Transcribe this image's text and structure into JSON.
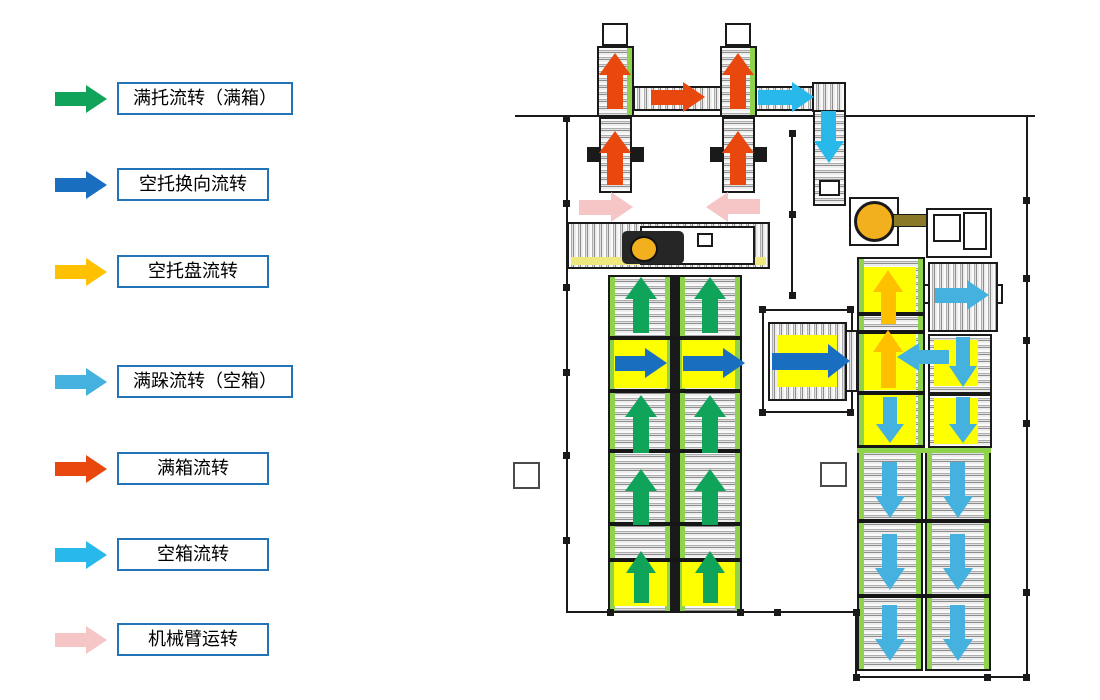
{
  "legend": {
    "items": [
      {
        "name": "full-pallet-flow",
        "label": "满托流转（满箱）",
        "flow": "full_pallet"
      },
      {
        "name": "empty-pallet-reverse-flow",
        "label": "空托换向流转",
        "flow": "empty_pallet_reverse"
      },
      {
        "name": "empty-tray-flow",
        "label": "空托盘流转",
        "flow": "empty_tray"
      },
      {
        "name": "full-stack-flow",
        "label": "满跺流转（空箱）",
        "flow": "full_stack"
      },
      {
        "name": "full-box-flow",
        "label": "满箱流转",
        "flow": "full_box"
      },
      {
        "name": "empty-box-flow",
        "label": "空箱流转",
        "flow": "empty_box"
      },
      {
        "name": "robot-arm-flow",
        "label": "机械臂运转",
        "flow": "robot_arm"
      }
    ],
    "tops": [
      82,
      168,
      255,
      365,
      452,
      538,
      623
    ],
    "box_border_color": "#2273b8"
  },
  "flow_colors": {
    "full_pallet": "#10a45b",
    "empty_pallet_reverse": "#1a6ebf",
    "empty_tray": "#ffc000",
    "full_stack": "#45b1de",
    "full_box": "#e8480e",
    "empty_box": "#29b8ea",
    "robot_arm": "#f6c6c6"
  },
  "diagram": {
    "arrows": [
      {
        "t": "full_box",
        "x": 615,
        "y": 81,
        "dir": "up",
        "len": 56,
        "w": 32
      },
      {
        "t": "full_box",
        "x": 738,
        "y": 81,
        "dir": "up",
        "len": 56,
        "w": 32
      },
      {
        "t": "full_box",
        "x": 678,
        "y": 97,
        "dir": "right",
        "len": 54,
        "w": 30
      },
      {
        "t": "full_box",
        "x": 615,
        "y": 158,
        "dir": "up",
        "len": 54,
        "w": 32
      },
      {
        "t": "full_box",
        "x": 738,
        "y": 158,
        "dir": "up",
        "len": 54,
        "w": 32
      },
      {
        "t": "empty_box",
        "x": 786,
        "y": 97,
        "dir": "right",
        "len": 56,
        "w": 30
      },
      {
        "t": "empty_box",
        "x": 829,
        "y": 137,
        "dir": "down",
        "len": 52,
        "w": 30
      },
      {
        "t": "robot_arm",
        "x": 606,
        "y": 207,
        "dir": "right",
        "len": 54,
        "w": 30
      },
      {
        "t": "robot_arm",
        "x": 733,
        "y": 207,
        "dir": "left",
        "len": 54,
        "w": 30
      },
      {
        "t": "full_pallet",
        "x": 641,
        "y": 305,
        "dir": "up",
        "len": 56,
        "w": 32
      },
      {
        "t": "full_pallet",
        "x": 710,
        "y": 305,
        "dir": "up",
        "len": 56,
        "w": 32
      },
      {
        "t": "full_pallet",
        "x": 641,
        "y": 424,
        "dir": "up",
        "len": 58,
        "w": 32
      },
      {
        "t": "full_pallet",
        "x": 710,
        "y": 424,
        "dir": "up",
        "len": 58,
        "w": 32
      },
      {
        "t": "full_pallet",
        "x": 641,
        "y": 497,
        "dir": "up",
        "len": 56,
        "w": 32
      },
      {
        "t": "full_pallet",
        "x": 710,
        "y": 497,
        "dir": "up",
        "len": 56,
        "w": 32
      },
      {
        "t": "full_pallet",
        "x": 641,
        "y": 577,
        "dir": "up",
        "len": 52,
        "w": 30
      },
      {
        "t": "full_pallet",
        "x": 710,
        "y": 577,
        "dir": "up",
        "len": 52,
        "w": 30
      },
      {
        "t": "empty_pallet_reverse",
        "x": 641,
        "y": 363,
        "dir": "right",
        "len": 52,
        "w": 30
      },
      {
        "t": "empty_pallet_reverse",
        "x": 714,
        "y": 363,
        "dir": "right",
        "len": 62,
        "w": 30
      },
      {
        "t": "empty_pallet_reverse",
        "x": 811,
        "y": 361,
        "dir": "right",
        "len": 78,
        "w": 34
      },
      {
        "t": "empty_tray",
        "x": 888,
        "y": 297,
        "dir": "up",
        "len": 54,
        "w": 30
      },
      {
        "t": "empty_tray",
        "x": 888,
        "y": 359,
        "dir": "up",
        "len": 58,
        "w": 30
      },
      {
        "t": "full_stack",
        "x": 962,
        "y": 295,
        "dir": "right",
        "len": 54,
        "w": 30
      },
      {
        "t": "full_stack",
        "x": 923,
        "y": 357,
        "dir": "left",
        "len": 52,
        "w": 28
      },
      {
        "t": "full_stack",
        "x": 963,
        "y": 362,
        "dir": "down",
        "len": 50,
        "w": 28
      },
      {
        "t": "full_stack",
        "x": 890,
        "y": 420,
        "dir": "down",
        "len": 46,
        "w": 28
      },
      {
        "t": "full_stack",
        "x": 963,
        "y": 420,
        "dir": "down",
        "len": 46,
        "w": 28
      },
      {
        "t": "full_stack",
        "x": 890,
        "y": 490,
        "dir": "down",
        "len": 56,
        "w": 30
      },
      {
        "t": "full_stack",
        "x": 958,
        "y": 490,
        "dir": "down",
        "len": 56,
        "w": 30
      },
      {
        "t": "full_stack",
        "x": 890,
        "y": 562,
        "dir": "down",
        "len": 56,
        "w": 30
      },
      {
        "t": "full_stack",
        "x": 958,
        "y": 562,
        "dir": "down",
        "len": 56,
        "w": 30
      },
      {
        "t": "full_stack",
        "x": 890,
        "y": 633,
        "dir": "down",
        "len": 56,
        "w": 30
      },
      {
        "t": "full_stack",
        "x": 958,
        "y": 633,
        "dir": "down",
        "len": 56,
        "w": 30
      }
    ],
    "walls": [
      [
        515,
        115,
        520,
        2
      ],
      [
        566,
        115,
        2,
        498
      ],
      [
        566,
        611,
        292,
        2
      ],
      [
        855,
        611,
        2,
        67
      ],
      [
        855,
        676,
        173,
        2
      ],
      [
        1026,
        115,
        2,
        563
      ],
      [
        791,
        133,
        2,
        162
      ]
    ],
    "markers": [
      [
        566,
        118
      ],
      [
        566,
        203
      ],
      [
        566,
        287
      ],
      [
        566,
        372
      ],
      [
        566,
        455
      ],
      [
        566,
        540
      ],
      [
        610,
        612
      ],
      [
        740,
        612
      ],
      [
        777,
        612
      ],
      [
        856,
        612
      ],
      [
        856,
        677
      ],
      [
        987,
        677
      ],
      [
        1026,
        677
      ],
      [
        1026,
        592
      ],
      [
        1026,
        200
      ],
      [
        1026,
        278
      ],
      [
        1026,
        340
      ],
      [
        1026,
        423
      ],
      [
        792,
        133
      ],
      [
        792,
        214
      ],
      [
        792,
        295
      ]
    ],
    "pillars": [
      [
        513,
        462,
        27,
        27
      ],
      [
        820,
        462,
        27,
        25
      ]
    ]
  }
}
